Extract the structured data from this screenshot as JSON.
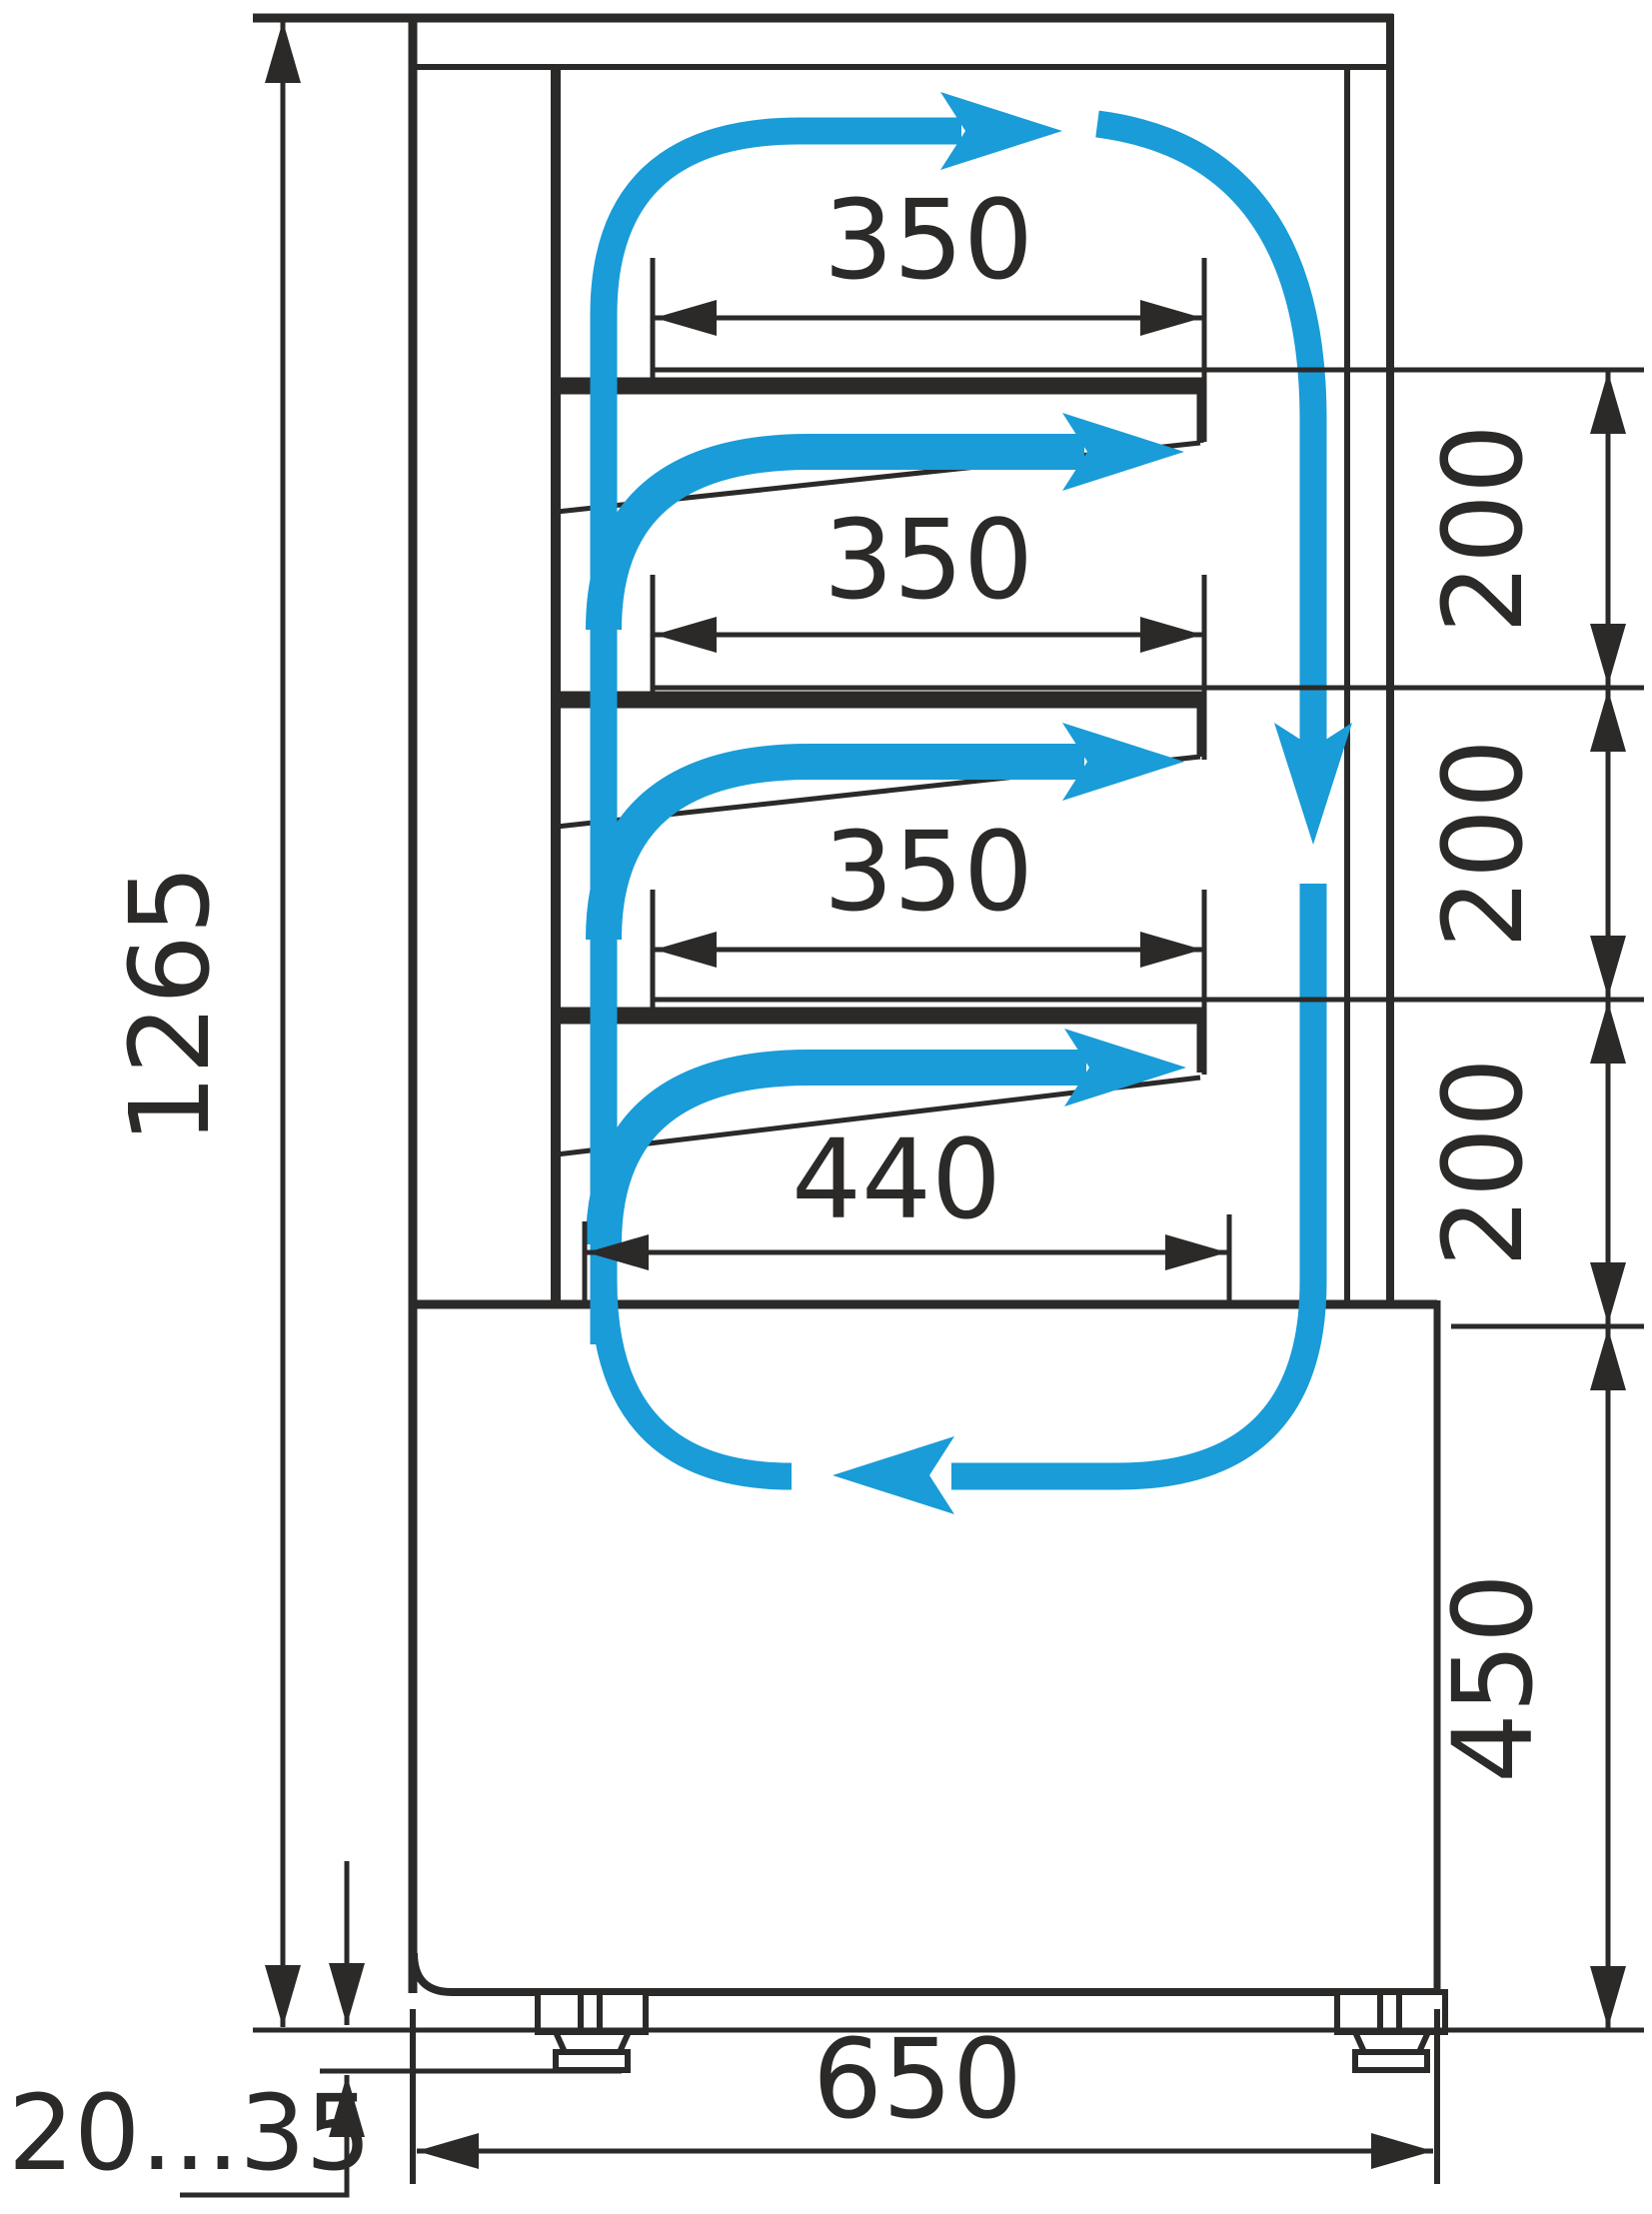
{
  "diagram": {
    "type": "technical-drawing",
    "subject": "refrigerated pastry display case - side section with air circulation",
    "units": "mm",
    "colors": {
      "accent": "#199cd8",
      "line": "#2b2a29",
      "background": "#ffffff"
    },
    "labels": {
      "overall_height": "1265",
      "shelf_top": "350",
      "shelf_middle": "350",
      "shelf_lower": "350",
      "bottom_shelf": "440",
      "spacing_top": "200",
      "spacing_middle": "200",
      "spacing_lower": "200",
      "base_height": "450",
      "depth": "650",
      "feet_range": "20...35"
    }
  }
}
